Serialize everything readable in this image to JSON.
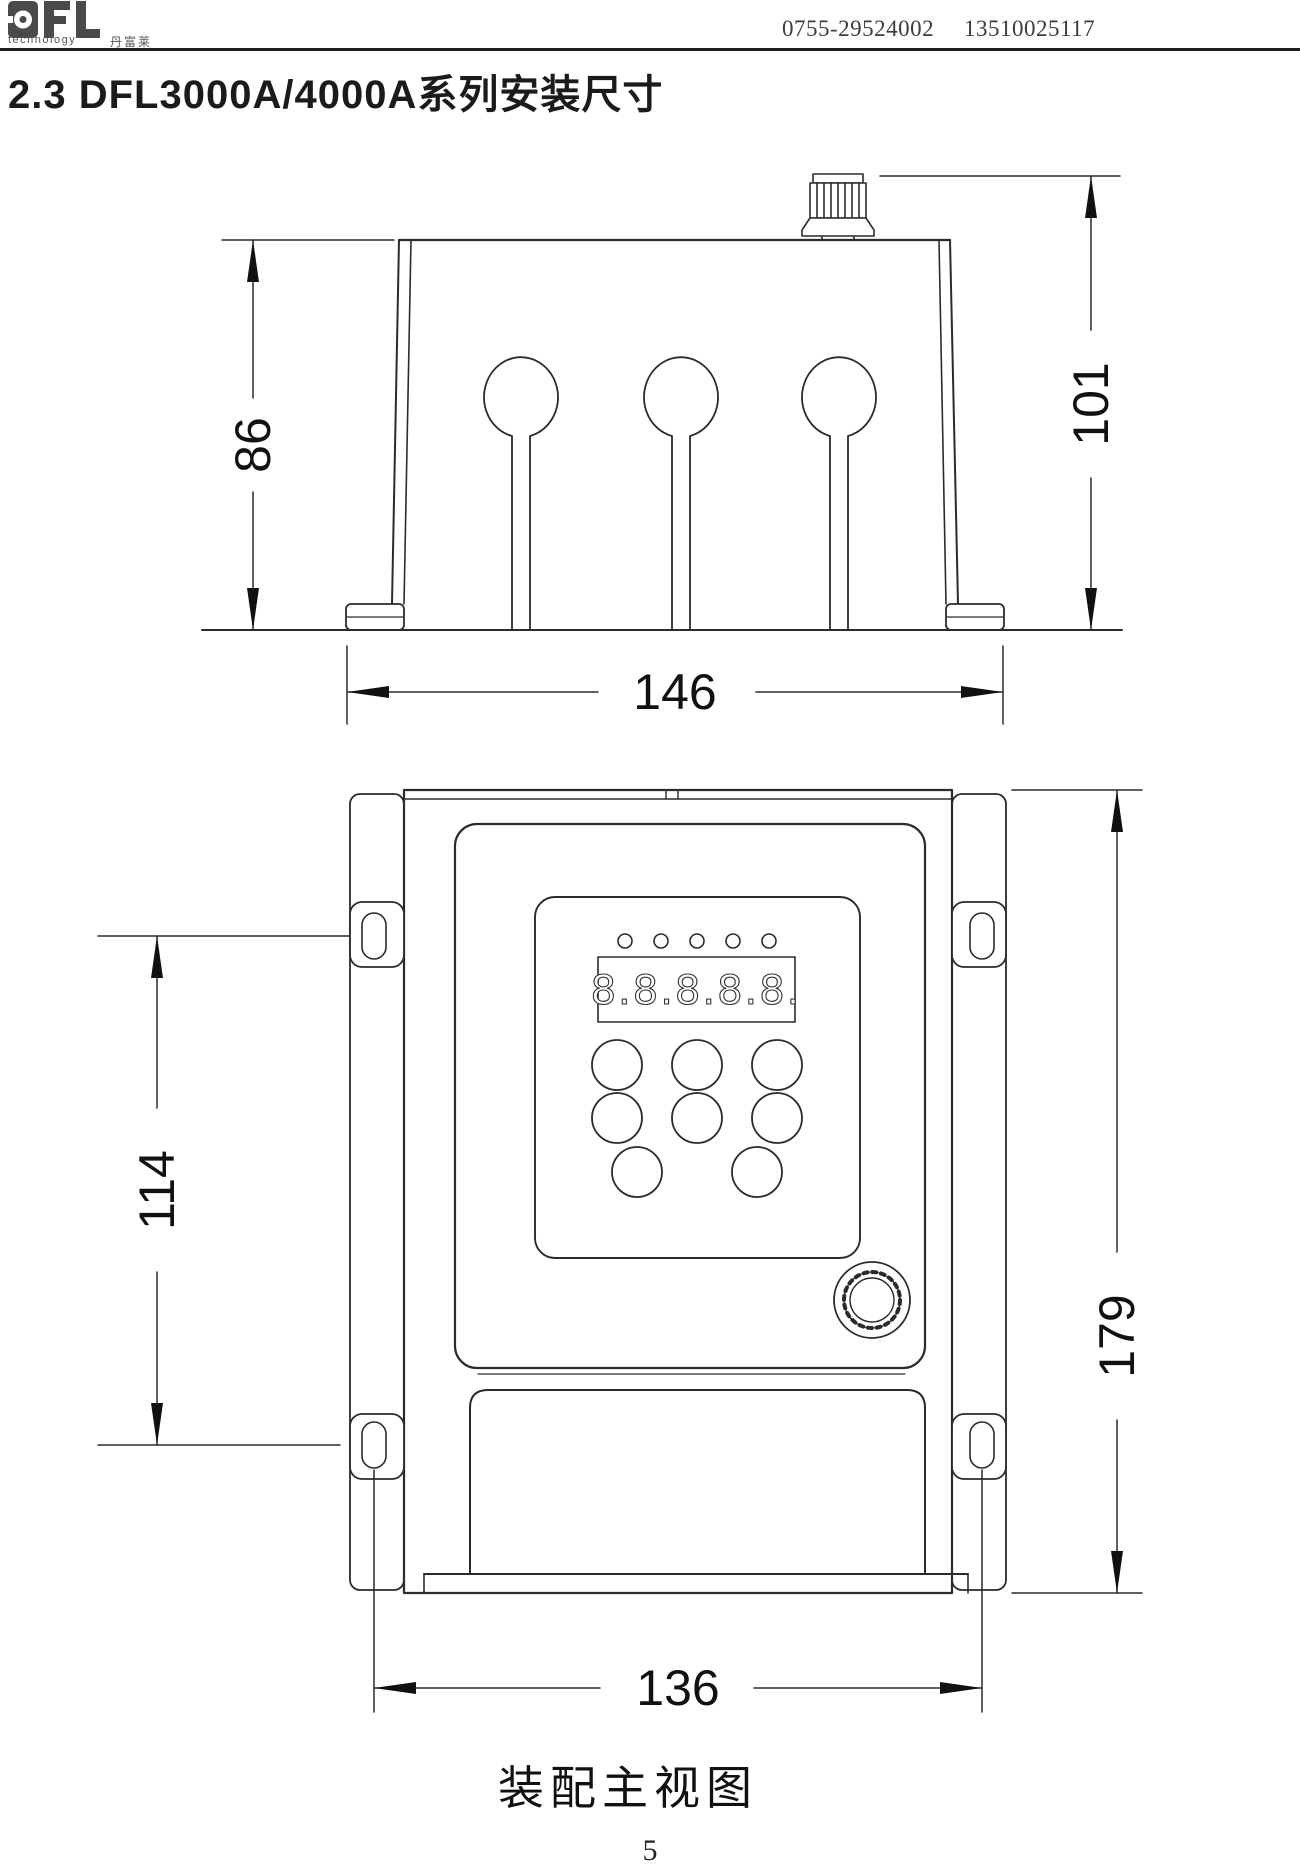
{
  "header": {
    "logo_text": "DFL",
    "logo_sub": "technology",
    "logo_cjk": "丹富莱",
    "phone_1": "0755-29524002",
    "phone_2": "13510025117"
  },
  "title": "2.3 DFL3000A/4000A系列安装尺寸",
  "figure": {
    "caption": "装配主视图",
    "page_number": "5",
    "display_value": "8.8.8.8.8.",
    "dimensions": {
      "side_body_height": "86",
      "side_total_height": "101",
      "side_width": "146",
      "front_slot_spacing": "114",
      "front_height": "179",
      "front_width": "136"
    }
  },
  "colors": {
    "line": "#2b2b2b",
    "text": "#111111",
    "background": "#ffffff"
  }
}
